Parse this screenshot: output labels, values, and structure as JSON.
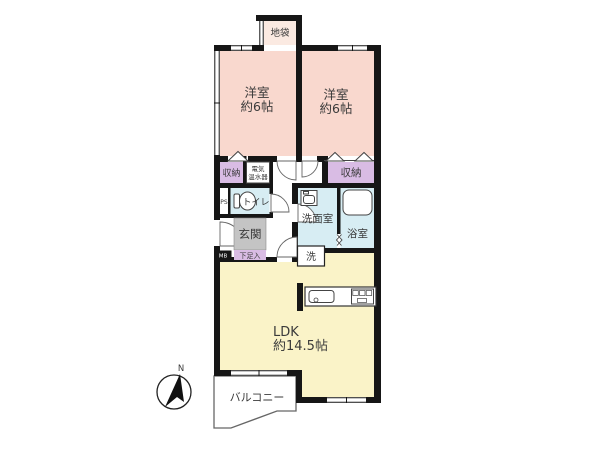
{
  "plan": {
    "type": "apartment-floor-plan",
    "rooms": {
      "bedroom_left": {
        "name": "洋室",
        "size": "約6帖"
      },
      "bedroom_right": {
        "name": "洋室",
        "size": "約6帖"
      },
      "ldk": {
        "name": "LDK",
        "size": "約14.5帖"
      },
      "balcony": {
        "name": "バルコニー"
      },
      "entrance": {
        "name": "玄関"
      },
      "toilet": {
        "name": "トイレ"
      },
      "washroom": {
        "name": "洗面室"
      },
      "bathroom": {
        "name": "浴室"
      },
      "closet_left": {
        "name": "収納"
      },
      "closet_right": {
        "name": "収納"
      },
      "floor_chest": {
        "name": "地袋"
      },
      "shoe_cabinet": {
        "name": "下足入"
      },
      "water_heater": {
        "line1": "電気",
        "line2": "温水器"
      },
      "pipe_space": {
        "name": "PS"
      },
      "meter_box": {
        "name": "MB"
      },
      "washer_space": {
        "name": "洗"
      }
    },
    "compass": {
      "north_label": "N"
    }
  },
  "colors": {
    "wall": "#161616",
    "bedroom": "#F9D8CE",
    "floor_chest": "#FBEAE2",
    "closet": "#D9BCE4",
    "wet": "#D7EDF3",
    "ldk": "#FAF3C8",
    "entrance_floor": "#C4C4C4",
    "meter_box": "#161616",
    "white": "#FFFFFF"
  }
}
